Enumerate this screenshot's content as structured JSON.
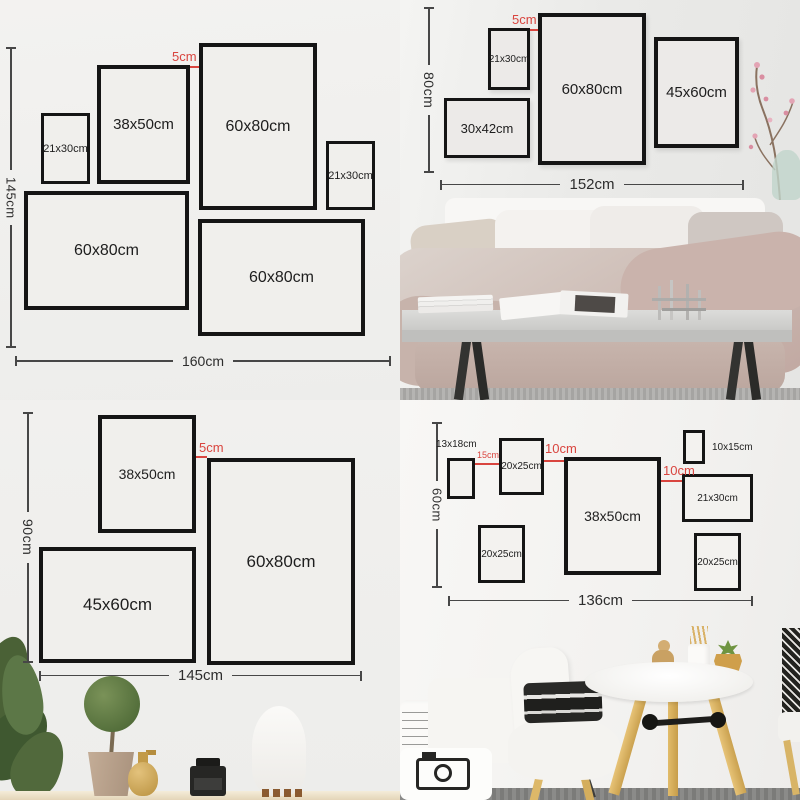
{
  "colors": {
    "accent_red": "#d9453f",
    "frame_border": "#151515"
  },
  "quadrants": {
    "tl": {
      "gap_label": "5cm",
      "height_label": "145cm",
      "width_label": "160cm",
      "frames": [
        {
          "label": "21x30cm"
        },
        {
          "label": "38x50cm"
        },
        {
          "label": "60x80cm"
        },
        {
          "label": "21x30cm"
        },
        {
          "label": "60x80cm"
        },
        {
          "label": "60x80cm"
        }
      ]
    },
    "tr": {
      "gap_label": "5cm",
      "height_label": "80cm",
      "width_label": "152cm",
      "frames": [
        {
          "label": "21x30cm"
        },
        {
          "label": "60x80cm"
        },
        {
          "label": "45x60cm"
        },
        {
          "label": "30x42cm"
        }
      ]
    },
    "bl": {
      "gap_label": "5cm",
      "height_label": "90cm",
      "width_label": "145cm",
      "frames": [
        {
          "label": "38x50cm"
        },
        {
          "label": "60x80cm"
        },
        {
          "label": "45x60cm"
        }
      ]
    },
    "br": {
      "gap_labels": {
        "g1": "15cm",
        "g2": "10cm",
        "g3": "10cm"
      },
      "height_label": "60cm",
      "width_label": "136cm",
      "frames": [
        {
          "label": "13x18cm"
        },
        {
          "label": "20x25cm"
        },
        {
          "label": "38x50cm"
        },
        {
          "label": "10x15cm"
        },
        {
          "label": "21x30cm"
        },
        {
          "label": "20x25cm"
        },
        {
          "label": "20x25cm"
        }
      ]
    }
  }
}
